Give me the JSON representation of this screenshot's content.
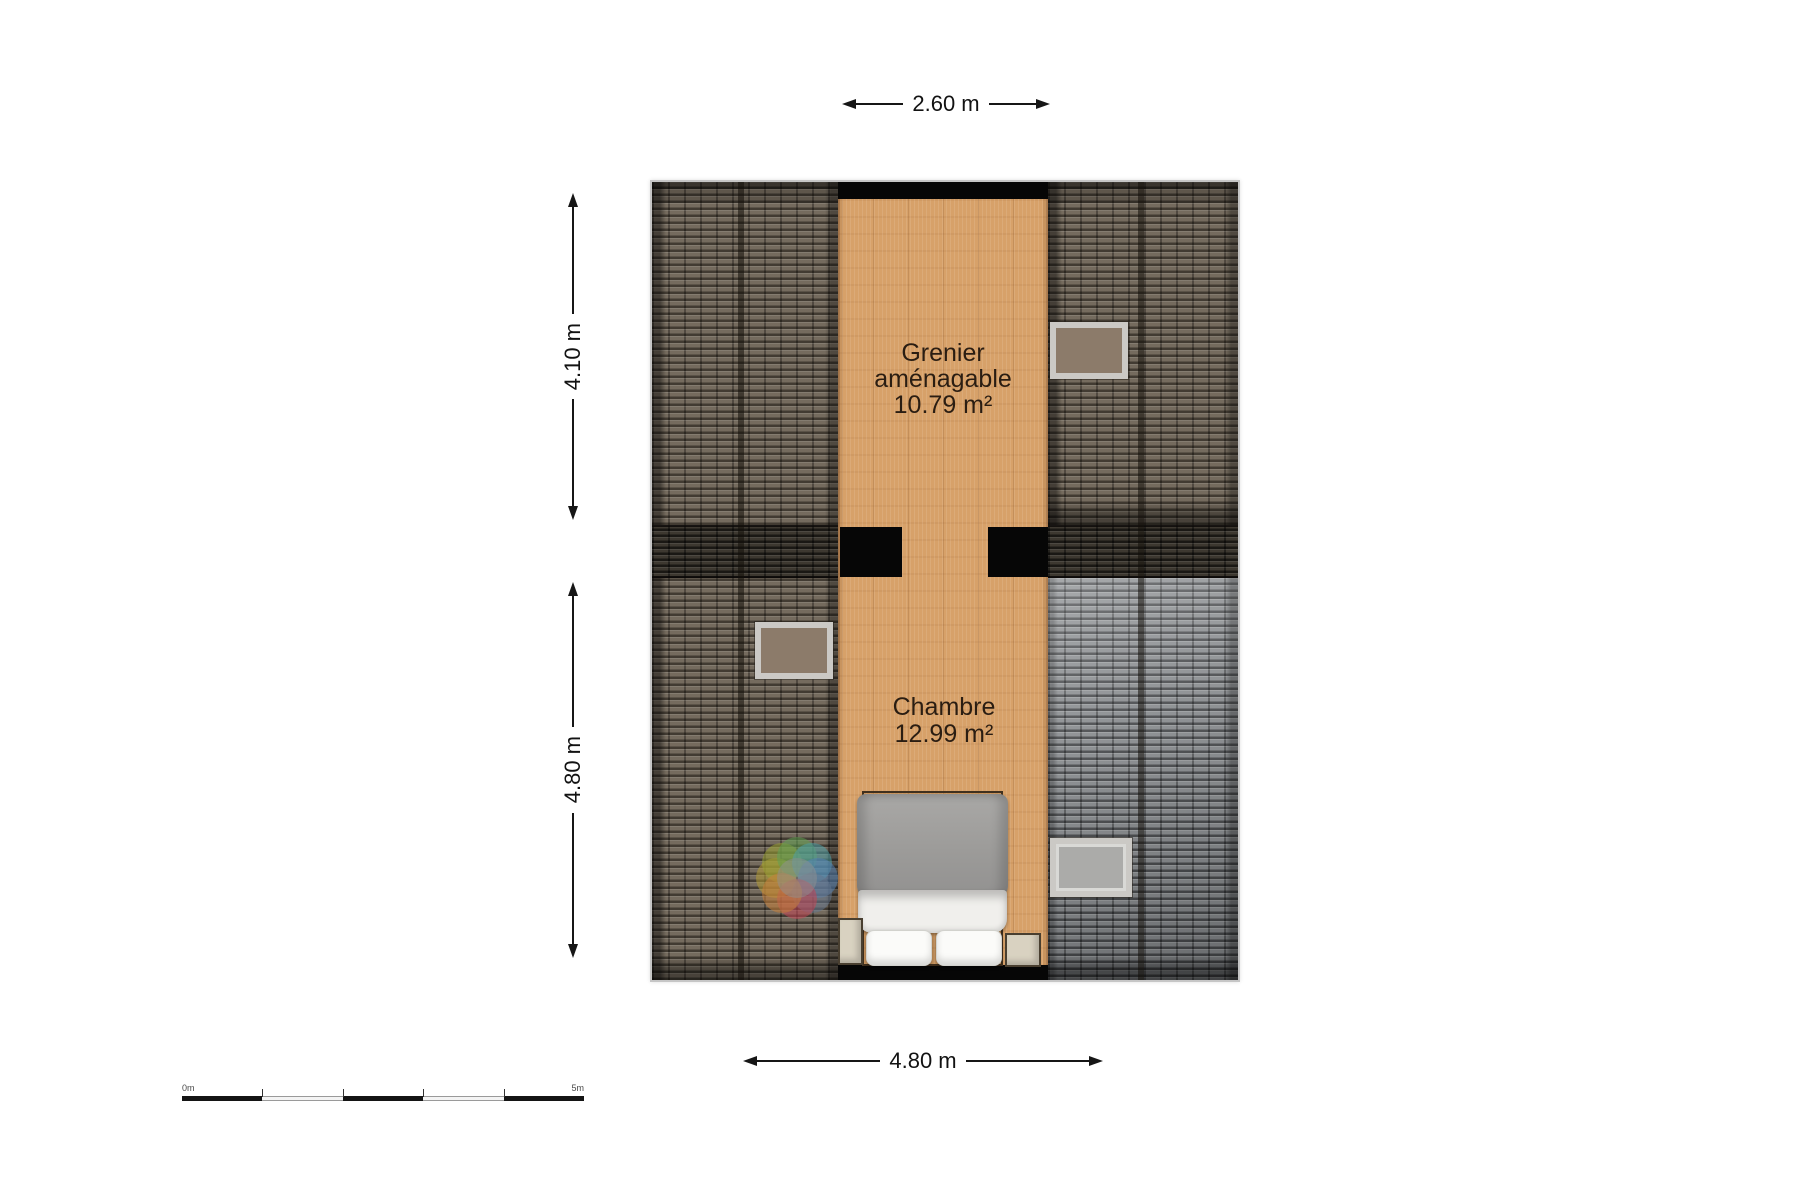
{
  "page": {
    "type": "attic floor plan",
    "background": "#ffffff"
  },
  "rooms": [
    {
      "id": "grenier",
      "label_line1": "Grenier",
      "label_line2": "aménagable",
      "area": "10.79 m²"
    },
    {
      "id": "chambre",
      "label_line1": "Chambre",
      "area": "12.99 m²"
    }
  ],
  "dimensions": {
    "top": "2.60 m",
    "left_upper": "4.10 m",
    "left_lower": "4.80 m",
    "bottom": "4.80 m"
  },
  "scale_bar": {
    "start_label": "0m",
    "end_label": "5m"
  },
  "colors": {
    "wood": "#d7a169",
    "roof_brown": "#6f6557",
    "roof_grey": "#85888b",
    "roof_band": "#39342c",
    "wall": "#060606",
    "window_frame": "#cbc9c5",
    "window_pane_brown": "#8c7b6a",
    "window_pane_grey": "#ababa9",
    "nightstand": "#d9d2c1"
  },
  "watermark": {
    "name": "floorplanner-flower-logo",
    "petal_colors": [
      "#b39a35",
      "#9aa233",
      "#61a152",
      "#4f9fa6",
      "#5681b5",
      "#64778e",
      "#c24556",
      "#c67f3b",
      "#8f8f8f"
    ]
  }
}
